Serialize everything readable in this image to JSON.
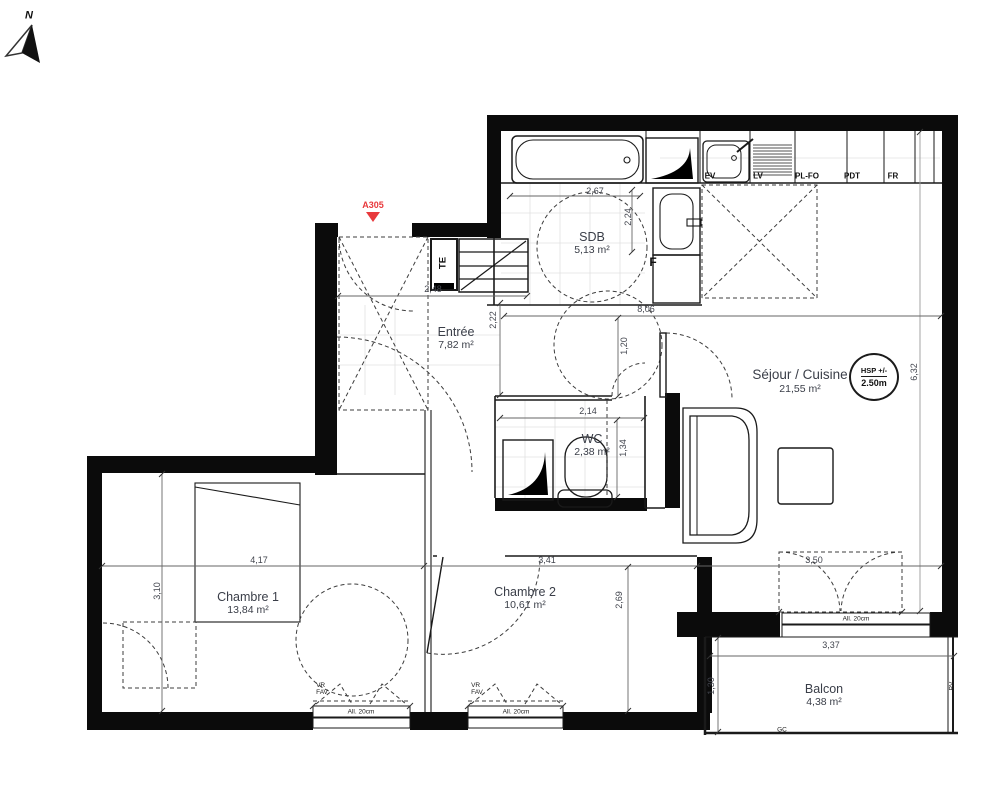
{
  "meta": {
    "north_label": "N",
    "unit_code": "A305",
    "hsp_badge": {
      "line1": "HSP +/-",
      "line2": "2.50m"
    }
  },
  "rooms": {
    "sdb": {
      "name": "SDB",
      "area": "5,13 m²"
    },
    "entree": {
      "name": "Entrée",
      "area": "7,82 m²"
    },
    "sejour": {
      "name": "Séjour / Cuisine",
      "area": "21,55 m²"
    },
    "wc": {
      "name": "WC",
      "area": "2,38 m²"
    },
    "chambre1": {
      "name": "Chambre 1",
      "area": "13,84 m²"
    },
    "chambre2": {
      "name": "Chambre 2",
      "area": "10,61 m²"
    },
    "balcon": {
      "name": "Balcon",
      "area": "4,38 m²"
    }
  },
  "dimensions": {
    "sdb_w": "2,67",
    "sdb_h": "2,24",
    "entree_w": "2,48",
    "entree_h": "2,22",
    "sejour_w": "8,06",
    "hall_h": "1,20",
    "sejour_h": "6,32",
    "wc_w": "2,14",
    "wc_h": "1,34",
    "ch1_w": "4,17",
    "ch1_h": "3,10",
    "ch2_w": "3,41",
    "ch2_h": "2,69",
    "balcony_door_w": "3,50",
    "balcon_w": "3,37",
    "balcon_h": "1,30"
  },
  "kitchen": {
    "ev": "EV",
    "lv": "LV",
    "plfo": "PL-FO",
    "pdt": "PDT",
    "fr": "FR"
  },
  "fixtures": {
    "te": "TE",
    "f": "F"
  },
  "window_notes": {
    "vr": "VR",
    "fav": "FAV",
    "sill": "All. 20cm",
    "gc": "GC",
    "pv": "PV"
  },
  "colors": {
    "accent_red": "#e8393c",
    "wall": "#0b0b0b",
    "text": "#3a3e48"
  }
}
